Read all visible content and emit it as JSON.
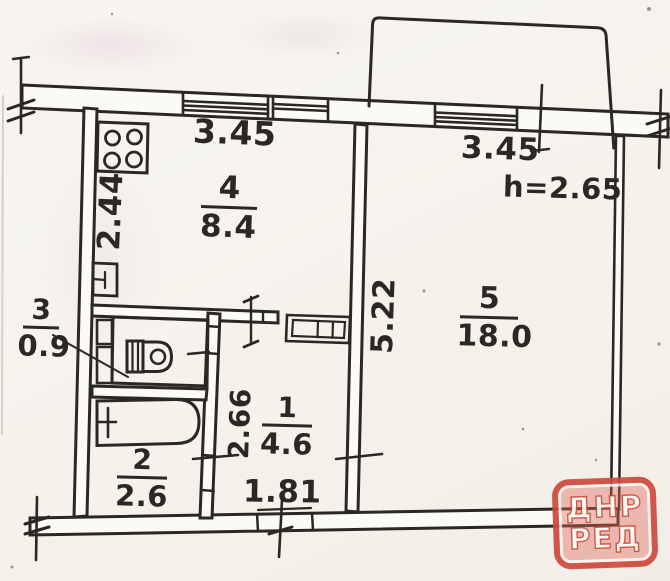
{
  "plan": {
    "height_note": "h=2.65",
    "rooms": [
      {
        "name": "hall",
        "number": "1",
        "area": "4.6"
      },
      {
        "name": "bath",
        "number": "2",
        "area": "2.6"
      },
      {
        "name": "wc",
        "number": "3",
        "area": "0.9"
      },
      {
        "name": "kitchen",
        "number": "4",
        "area": "8.4"
      },
      {
        "name": "room",
        "number": "5",
        "area": "18.0"
      }
    ],
    "dimensions": {
      "kitchen_width": "3.45",
      "room_width": "3.45",
      "kitchen_depth": "2.44",
      "room_depth": "5.22",
      "hall_depth": "2.66",
      "entry_width": "1.81"
    }
  },
  "watermark": {
    "line1": "ДНР",
    "line2": "РЕД"
  },
  "icons": {
    "stove-icon": "four-burner stove",
    "sink-icon": "kitchen sink",
    "toilet-icon": "toilet",
    "bathtub-icon": "bathtub with tap",
    "closet-icon": "built-in wardrobe",
    "window-icon": "window in wall",
    "balcony-icon": "balcony outline",
    "break-mark-icon": "wall break mark"
  },
  "colors": {
    "ink": "#2b2823",
    "paper": "#f5f2ed",
    "watermark_red": "#cf4a3d"
  }
}
